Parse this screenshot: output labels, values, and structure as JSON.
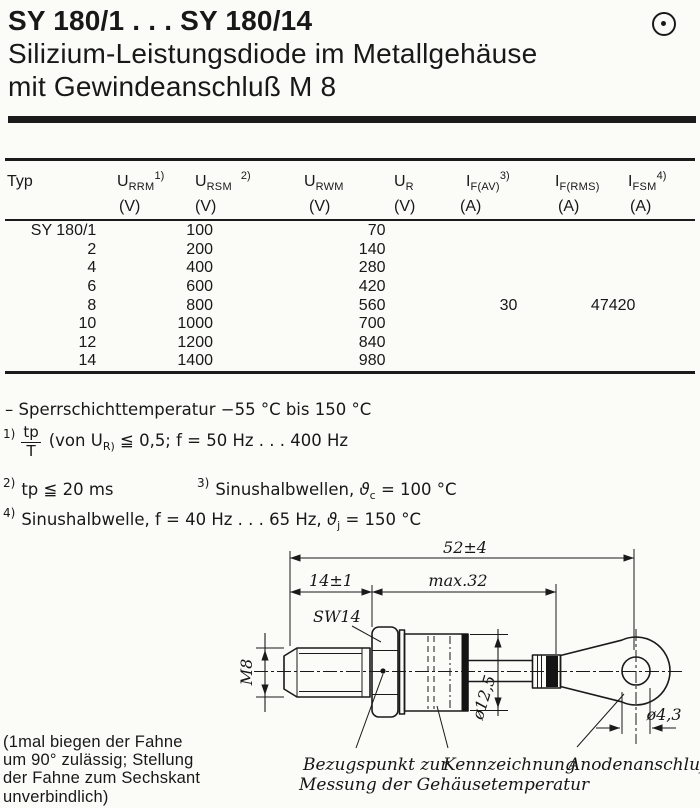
{
  "page": {
    "title": "SY 180/1 . . . SY 180/14",
    "subtitle_line1": "Silizium-Leistungsdiode im Metallgehäuse",
    "subtitle_line2": "mit Gewindeanschluß M 8"
  },
  "icons": {
    "page_mark": "dot-circle"
  },
  "colors": {
    "ink": "#181818",
    "paper": "#fbfbf7"
  },
  "table": {
    "columns": [
      {
        "sym": "Typ",
        "sub": "",
        "sup": "",
        "unit": ""
      },
      {
        "sym": "U",
        "sub": "RRM",
        "sup": "1)",
        "unit": "(V)"
      },
      {
        "sym": "U",
        "sub": "RSM",
        "sup": "2)",
        "unit": "(V)"
      },
      {
        "sym": "U",
        "sub": "RWM",
        "sup": "",
        "unit": "(V)"
      },
      {
        "sym": "U",
        "sub": "R",
        "sup": "",
        "unit": "(V)"
      },
      {
        "sym": "I",
        "sub": "F(AV)",
        "sup": "3)",
        "unit": "(A)"
      },
      {
        "sym": "I",
        "sub": "F(RMS)",
        "sup": "",
        "unit": "(A)"
      },
      {
        "sym": "I",
        "sub": "FSM",
        "sup": "4)",
        "unit": "(A)"
      }
    ],
    "rows": [
      {
        "typ": "SY 180/1",
        "urrm": "100",
        "urwm": "70",
        "ifav": "",
        "ifrms": "",
        "ifsm": ""
      },
      {
        "typ": "2",
        "urrm": "200",
        "urwm": "140",
        "ifav": "",
        "ifrms": "",
        "ifsm": ""
      },
      {
        "typ": "4",
        "urrm": "400",
        "urwm": "280",
        "ifav": "",
        "ifrms": "",
        "ifsm": ""
      },
      {
        "typ": "6",
        "urrm": "600",
        "urwm": "420",
        "ifav": "",
        "ifrms": "",
        "ifsm": ""
      },
      {
        "typ": "8",
        "urrm": "800",
        "urwm": "560",
        "ifav": "30",
        "ifrms": "47",
        "ifsm": "420"
      },
      {
        "typ": "10",
        "urrm": "1000",
        "urwm": "700",
        "ifav": "",
        "ifrms": "",
        "ifsm": ""
      },
      {
        "typ": "12",
        "urrm": "1200",
        "urwm": "840",
        "ifav": "",
        "ifrms": "",
        "ifsm": ""
      },
      {
        "typ": "14",
        "urrm": "1400",
        "urwm": "980",
        "ifav": "",
        "ifrms": "",
        "ifsm": ""
      }
    ]
  },
  "notes": {
    "temp": "– Sperrschichttemperatur −55 °C bis 150 °C",
    "fn1_marker": "1)",
    "fn1_frac_num": "tp",
    "fn1_frac_den": "T",
    "fn1_pre": "(von U",
    "fn1_sub": "R)",
    "fn1_post": "≦ 0,5; f = 50 Hz . . . 400 Hz",
    "fn2_marker": "2)",
    "fn2_text": "tp ≦ 20 ms",
    "fn3_marker": "3)",
    "fn3_text": "Sinushalbwellen,",
    "fn3_theta": "ϑ",
    "fn3_theta_sub": "c",
    "fn3_eq": "= 100 °C",
    "fn4_marker": "4)",
    "fn4_text": "Sinushalbwelle, f = 40 Hz . . . 65 Hz,",
    "fn4_theta": "ϑ",
    "fn4_theta_sub": "j",
    "fn4_eq": "= 150 °C"
  },
  "drawing": {
    "dim_total": "52±4",
    "dim_thread_len": "14±1",
    "dim_body_len": "max.32",
    "wrench_size": "SW14",
    "thread": "M8",
    "body_dia": "ø12,5",
    "hole_dia": "ø4,3",
    "label_ref_1": "Bezugspunkt zur",
    "label_ref_2": "Messung der Gehäusetemperatur",
    "label_marking": "Kennzeichnung",
    "label_anode": "Anodenanschluß"
  },
  "footer_note": {
    "line1": "(1mal biegen der Fahne",
    "line2": "um 90° zulässig; Stellung",
    "line3": "der Fahne zum Sechskant",
    "line4": "unverbindlich)"
  }
}
